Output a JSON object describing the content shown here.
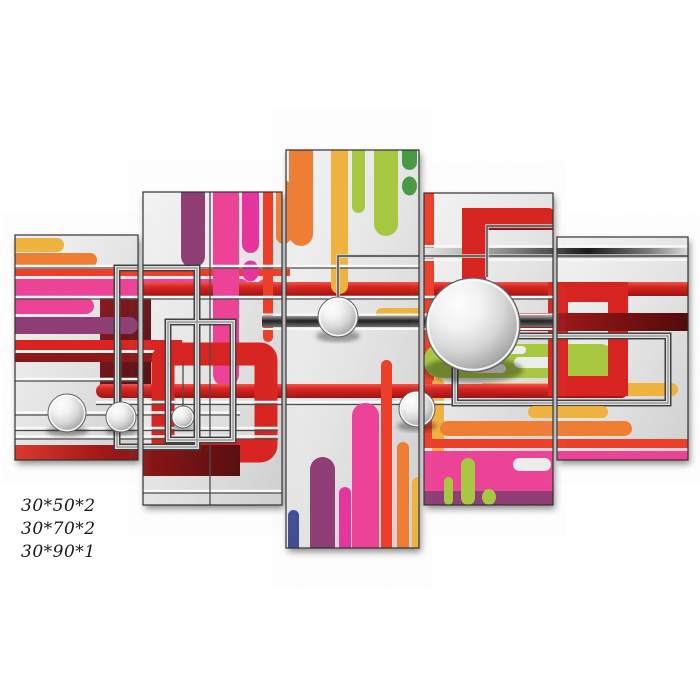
{
  "artwork": {
    "description": "Abstract modern 5-panel canvas wall art print with colorful rounded stripes, red pipe rectangles, chrome wire frames and glossy silver spheres",
    "panel_count": 5,
    "size_labels": [
      "30*50*2",
      "30*70*2",
      "30*90*1"
    ]
  },
  "palette": {
    "red": "#d9201c",
    "darkred": "#8c1212",
    "maroon": "#5c090c",
    "pink": "#ee3f96",
    "magenta": "#e8319b",
    "purple": "#8e3a74",
    "navy": "#3d4a95",
    "orange": "#f07c30",
    "redorange": "#ee3b25",
    "amber": "#f0b33c",
    "lgreen": "#a7c83d",
    "dgreen": "#44993f",
    "textcolor": "#1a1a1a"
  }
}
